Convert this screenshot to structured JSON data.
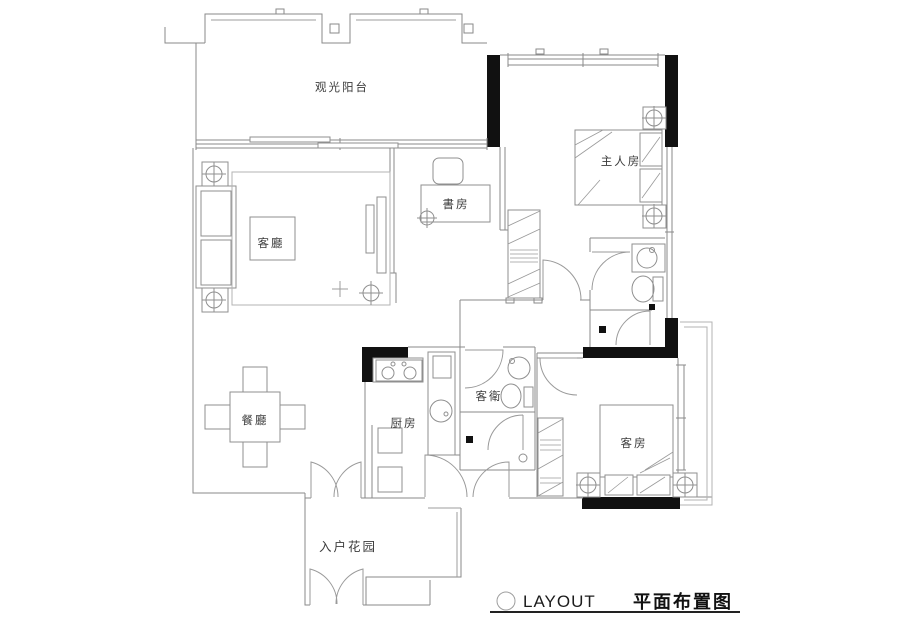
{
  "rooms": {
    "balcony": "观光阳台",
    "master_bedroom": "主人房",
    "study": "書房",
    "living_room": "客廳",
    "dining_room": "餐廳",
    "kitchen": "厨房",
    "guest_bathroom": "客衛",
    "guest_bedroom": "客房",
    "entry_garden": "入户花园"
  },
  "title_block": {
    "latin": "LAYOUT",
    "chinese": "平面布置图"
  },
  "colors": {
    "structural_wall": "#111111",
    "line": "#8a8a8a",
    "text": "#3c3c3c",
    "background": "#ffffff"
  }
}
